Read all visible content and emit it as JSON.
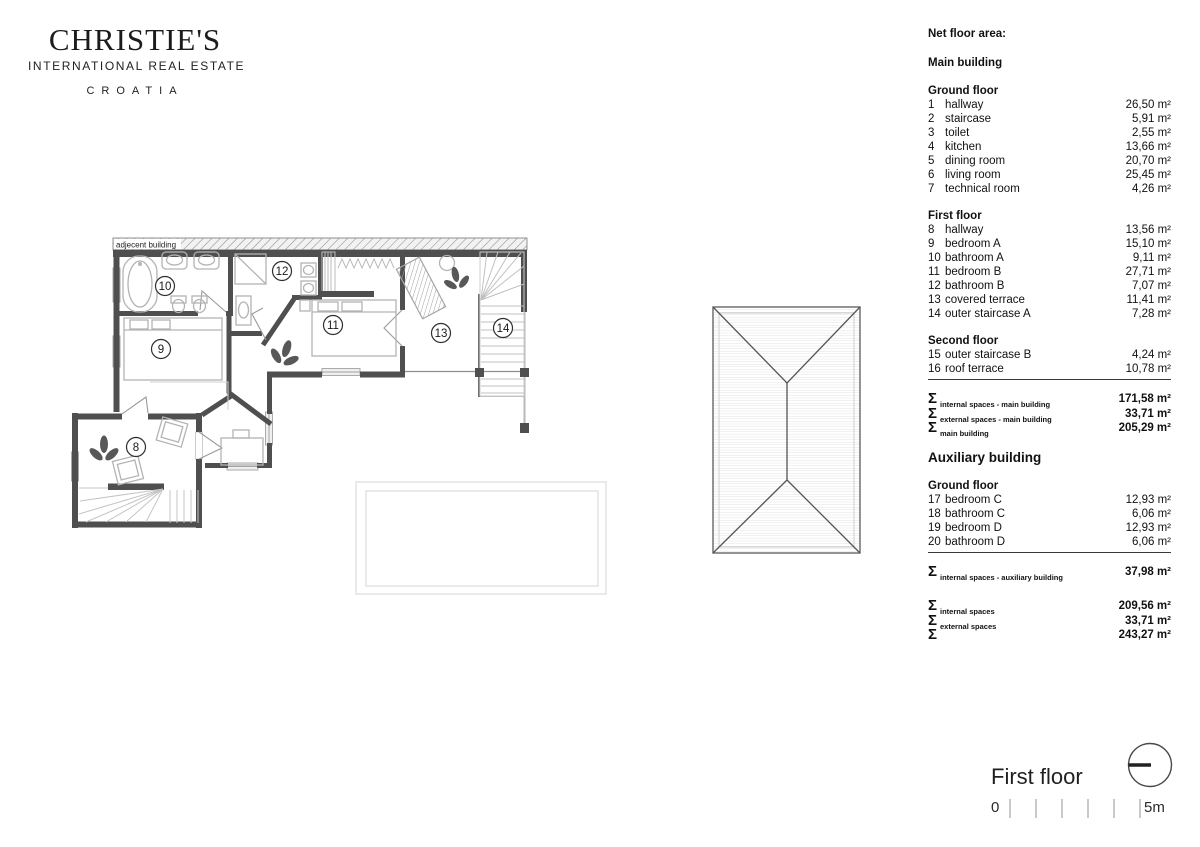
{
  "logo": {
    "brand": "CHRISTIE'S",
    "subtitle": "INTERNATIONAL REAL ESTATE",
    "region": "CROATIA"
  },
  "plan": {
    "adjacent_building_label": "adjecent building",
    "room_numbers": [
      {
        "label": "10",
        "x": 165,
        "y": 286
      },
      {
        "label": "12",
        "x": 282,
        "y": 271
      },
      {
        "label": "11",
        "x": 333,
        "y": 325
      },
      {
        "label": "13",
        "x": 441,
        "y": 333
      },
      {
        "label": "14",
        "x": 503,
        "y": 328
      },
      {
        "label": "9",
        "x": 161,
        "y": 349
      },
      {
        "label": "8",
        "x": 136,
        "y": 447
      }
    ]
  },
  "area_table": {
    "title": "Net floor area:",
    "sigma_symbol": "Σ",
    "sections": [
      {
        "type": "subtitle",
        "text": "Main building"
      },
      {
        "type": "group",
        "heading": "Ground floor",
        "rows": [
          {
            "no": "1",
            "label": "hallway",
            "area": "26,50 m²"
          },
          {
            "no": "2",
            "label": "staircase",
            "area": "5,91 m²"
          },
          {
            "no": "3",
            "label": "toilet",
            "area": "2,55 m²"
          },
          {
            "no": "4",
            "label": "kitchen",
            "area": "13,66 m²"
          },
          {
            "no": "5",
            "label": "dining room",
            "area": "20,70 m²"
          },
          {
            "no": "6",
            "label": "living room",
            "area": "25,45 m²"
          },
          {
            "no": "7",
            "label": "technical room",
            "area": "4,26 m²"
          }
        ]
      },
      {
        "type": "group",
        "heading": "First floor",
        "rows": [
          {
            "no": "8",
            "label": "hallway",
            "area": "13,56 m²"
          },
          {
            "no": "9",
            "label": "bedroom A",
            "area": "15,10 m²"
          },
          {
            "no": "10",
            "label": "bathroom A",
            "area": "9,11 m²"
          },
          {
            "no": "11",
            "label": "bedroom B",
            "area": "27,71 m²"
          },
          {
            "no": "12",
            "label": "bathroom B",
            "area": "7,07 m²"
          },
          {
            "no": "13",
            "label": "covered terrace",
            "area": "11,41 m²"
          },
          {
            "no": "14",
            "label": "outer staircase A",
            "area": "7,28 m²"
          }
        ]
      },
      {
        "type": "group",
        "heading": "Second floor",
        "rule_after": true,
        "rows": [
          {
            "no": "15",
            "label": "outer staircase B",
            "area": "4,24 m²"
          },
          {
            "no": "16",
            "label": "roof terrace",
            "area": "10,78 m²"
          }
        ]
      },
      {
        "type": "sigmas",
        "rows": [
          {
            "label": "internal spaces - main building",
            "area": "171,58 m²"
          },
          {
            "label": "external spaces - main building",
            "area": "33,71 m²"
          },
          {
            "label": "main building",
            "area": "205,29 m²"
          }
        ]
      },
      {
        "type": "subtitle",
        "text": "Auxiliary building",
        "large": true
      },
      {
        "type": "group",
        "heading": "Ground floor",
        "rule_after": true,
        "rows": [
          {
            "no": "17",
            "label": "bedroom C",
            "area": "12,93 m²"
          },
          {
            "no": "18",
            "label": "bathroom C",
            "area": "6,06 m²"
          },
          {
            "no": "19",
            "label": "bedroom D",
            "area": "12,93 m²"
          },
          {
            "no": "20",
            "label": "bathroom D",
            "area": "6,06 m²"
          }
        ]
      },
      {
        "type": "sigmas",
        "rows": [
          {
            "label": "internal spaces - auxiliary building",
            "area": "37,98 m²"
          }
        ]
      },
      {
        "type": "sigmas",
        "rows": [
          {
            "label": "internal spaces",
            "area": "209,56 m²"
          },
          {
            "label": "external spaces",
            "area": "33,71 m²"
          },
          {
            "label": "",
            "area": "243,27 m²"
          }
        ]
      }
    ]
  },
  "footer": {
    "floor_label": "First floor",
    "scale_zero": "0",
    "scale_end": "5m"
  }
}
